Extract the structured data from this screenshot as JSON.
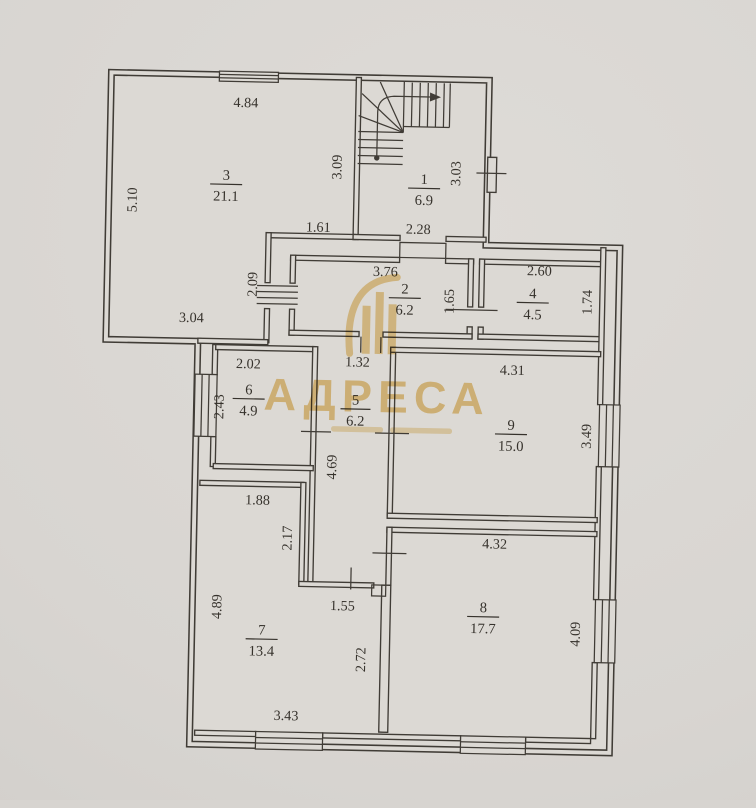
{
  "watermark": {
    "brand": "АДРЕСА",
    "color": "#e4b553"
  },
  "rooms": {
    "room1": {
      "number": "1",
      "area": "6.9"
    },
    "room2": {
      "number": "2",
      "area": "6.2"
    },
    "room3": {
      "number": "3",
      "area": "21.1"
    },
    "room4": {
      "number": "4",
      "area": "4.5"
    },
    "room5": {
      "number": "5",
      "area": "6.2"
    },
    "room6": {
      "number": "6",
      "area": "4.9"
    },
    "room7": {
      "number": "7",
      "area": "13.4"
    },
    "room8": {
      "number": "8",
      "area": "17.7"
    },
    "room9": {
      "number": "9",
      "area": "15.0"
    }
  },
  "dims": {
    "room3": {
      "top": "4.84",
      "left": "5.10",
      "right": "3.09",
      "bottom": "3.04",
      "notch": "1.61",
      "door": "2.09"
    },
    "room1": {
      "bottom": "2.28",
      "right": "3.03"
    },
    "room2": {
      "top": "3.76",
      "right": "1.65"
    },
    "room4": {
      "top": "2.60",
      "right": "1.74"
    },
    "room6": {
      "top": "2.02",
      "left": "2.43"
    },
    "room5": {
      "top": "1.32",
      "left": "4.69"
    },
    "room9": {
      "top": "4.31",
      "right": "3.49"
    },
    "room7": {
      "top": "1.88",
      "upper_right": "2.17",
      "left": "4.89",
      "inner": "1.55",
      "right": "2.72",
      "bottom": "3.43"
    },
    "room8": {
      "top": "4.32",
      "right": "4.09"
    }
  }
}
